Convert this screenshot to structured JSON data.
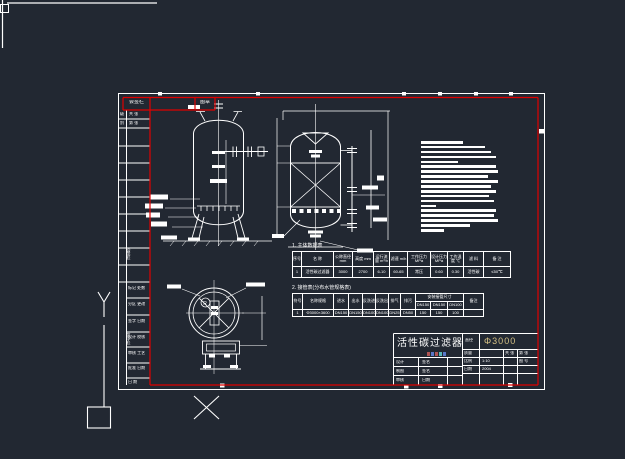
{
  "colors": {
    "background": "#222832",
    "line": "#ffffff",
    "frame_red": "#e00000",
    "accent_value": "#d4c084"
  },
  "header_strip": {
    "cell1": "会签栏",
    "cell2": "图章"
  },
  "sign_column": {
    "top_rows": [
      {
        "c1": "级",
        "c2": "共 张"
      },
      {
        "c1": "别",
        "c2": "第 张"
      }
    ],
    "vertical_label_upper": "会签栏",
    "vertical_label_lower": "签字栏",
    "rows": [
      "标记 处数",
      "分区 更改",
      "签字 日期",
      "设计 校核",
      "审核 工艺",
      "批准 日期",
      "日 期"
    ]
  },
  "notes": {
    "bars": [
      42,
      64,
      70,
      75,
      37,
      75,
      77,
      67,
      77,
      70,
      75,
      68,
      73,
      15,
      75,
      73,
      77,
      49,
      23
    ]
  },
  "table1": {
    "title": "1. 主体数据表",
    "col_widths": [
      9,
      32,
      19,
      21,
      16,
      18,
      23,
      17,
      16,
      20,
      27
    ],
    "headers": [
      "序号",
      "名 称",
      "公称直径 mm",
      "高度 mm",
      "运行流量 m³/h",
      "滤速 m/h",
      "工作压力 MPa",
      "设计压力 MPa",
      "工作温度 ℃",
      "滤 料",
      "备 注"
    ],
    "rows": [
      [
        "1",
        "活性碳过滤器",
        "3000",
        "2700",
        "6-10",
        "60-65",
        "常压",
        "0.60",
        "0.30",
        "活性碳",
        "≤50℃"
      ]
    ]
  },
  "table2": {
    "title": "2. 接管表(分布水管规格表)",
    "col_widths": [
      10,
      31,
      15,
      14,
      13,
      13,
      12,
      15,
      15,
      17,
      16,
      20
    ],
    "header_rows": [
      [
        {
          "t": "符号",
          "rs": 2
        },
        {
          "t": "名称规格",
          "rs": 2
        },
        {
          "t": "进水",
          "rs": 2
        },
        {
          "t": "出水",
          "rs": 2
        },
        {
          "t": "反洗进",
          "rs": 2
        },
        {
          "t": "反洗出",
          "rs": 2
        },
        {
          "t": "排气",
          "rs": 2
        },
        {
          "t": "排污",
          "rs": 2
        },
        {
          "t": "安装接管尺寸",
          "cs": 3
        },
        {
          "t": "备注",
          "rs": 2
        }
      ],
      [
        {
          "t": "DN150"
        },
        {
          "t": "DN150"
        },
        {
          "t": "DN100"
        }
      ]
    ],
    "rows": [
      [
        "1",
        "Φ3000×3600",
        "DN150",
        "DN150",
        "DN100",
        "DN100",
        "DN25",
        "DN50",
        "150",
        "150",
        "100",
        ""
      ]
    ]
  },
  "title_block": {
    "drawing_title": "活性碳过滤器",
    "spec_label": "直径",
    "spec_value": "Φ3000",
    "cells": {
      "r1c1": "质量",
      "r1c3": "共 张",
      "r1c4": "第 张",
      "r2c1": "比例",
      "r2c2": "1:10",
      "r2c4": "图 号",
      "r3c1": "日期",
      "r3c2": "2004",
      "l1a": "设计",
      "l1b": "签名",
      "l2a": "制图",
      "l2b": "签名",
      "l3a": "审核",
      "l3b": "日期"
    },
    "micro_marks": [
      "#b05555",
      "#5a78c8",
      "#b05555",
      "#57b8b8",
      "#5a78c8"
    ]
  },
  "plan_view": {
    "radius_label": "R"
  }
}
